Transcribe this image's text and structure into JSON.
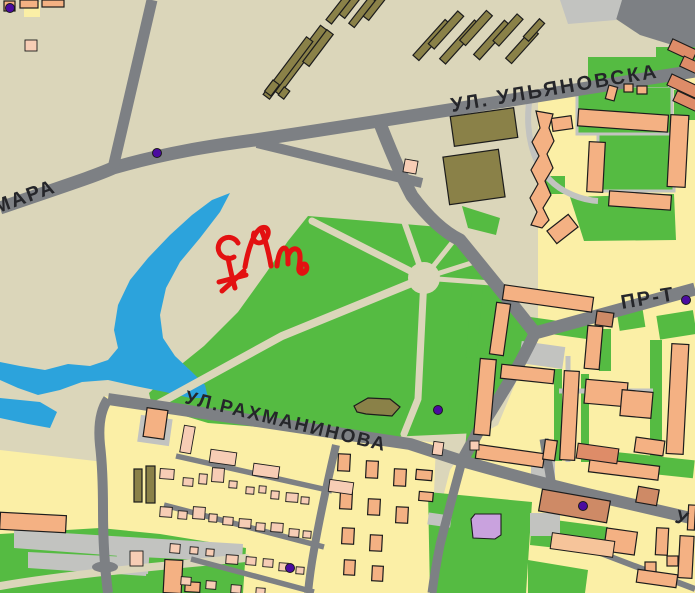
{
  "map": {
    "type": "city-street-map",
    "street_labels": {
      "ulyanovska": "УЛ. УЛЬЯНОВСКА",
      "mara": "МАРА",
      "rakhmaninova": "УЛ.РАХМАНИНОВА",
      "prospekt": "ПР-Т",
      "street_cut": "У"
    },
    "annotation": {
      "description": "hand-drawn red marker scribble over the lake shore",
      "color": "#e31111"
    },
    "poi": {
      "marker_count": 6,
      "color": "#4b0ba0"
    },
    "legend": {
      "water": "lake / pond",
      "green": "park and courtyard greenery",
      "urban": "built-up residential blocks",
      "base": "open ground",
      "building": "apartment buildings",
      "house": "small private houses",
      "olive": "industrial / barracks buildings",
      "road": "streets"
    },
    "palette": {
      "base": "#dbd6ba",
      "urban": "#fbefa6",
      "green": "#55bb42",
      "water": "#2ca3dc",
      "road": "#7d8084",
      "path": "#c2c3c0",
      "building": "#f4b183",
      "building_stroke": "#1c1c1c",
      "house": "#f7cdb5",
      "salmon": "#de8c68",
      "brown": "#ce8a66",
      "light_orange": "#f6c49a",
      "olive": "#8a8148",
      "purple": "#c9a2de",
      "poi": "#4b0ba0",
      "annotation": "#e31111",
      "label": "#25262a"
    }
  }
}
